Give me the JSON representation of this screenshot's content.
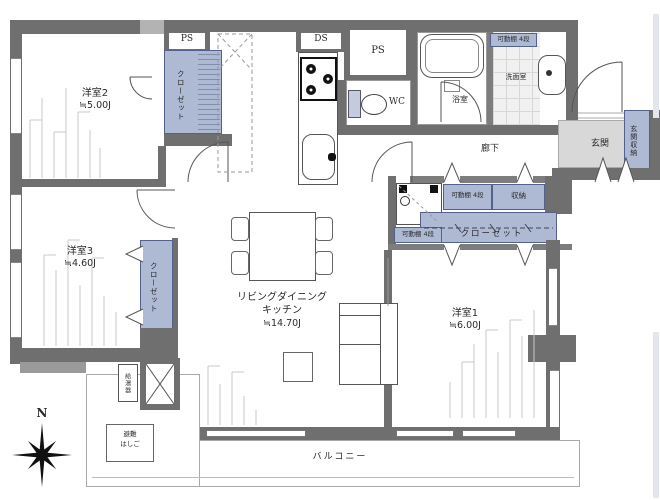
{
  "floorplan": {
    "rooms": {
      "bedroom2": {
        "name": "洋室2",
        "area": "≒5.00J"
      },
      "bedroom3": {
        "name": "洋室3",
        "area": "≒4.60J"
      },
      "bedroom1": {
        "name": "洋室1",
        "area": "≒6.00J"
      },
      "ldk": {
        "line1": "リビングダイニング",
        "line2": "キッチン",
        "area": "≒14.70J"
      },
      "bath": "浴室",
      "washroom": "洗面室",
      "wc": "WC",
      "corridor": "廊下",
      "entrance": "玄関",
      "entrance_storage": "玄関収納",
      "balcony": "バルコニー"
    },
    "fixtures": {
      "ps": "PS",
      "ds": "DS",
      "closet": "クローゼット",
      "shelf": "可動棚 4段",
      "storage": "収納",
      "water_heater": "給湯器",
      "ladder_line1": "避難",
      "ladder_line2": "はしご",
      "north": "N"
    },
    "colors": {
      "wall": "#6f6f6f",
      "wall_light": "#b3b3b3",
      "closet_fill": "#aeb9d4",
      "entrance_floor": "#d8d8d8",
      "tile": "#f1f1f1"
    }
  }
}
